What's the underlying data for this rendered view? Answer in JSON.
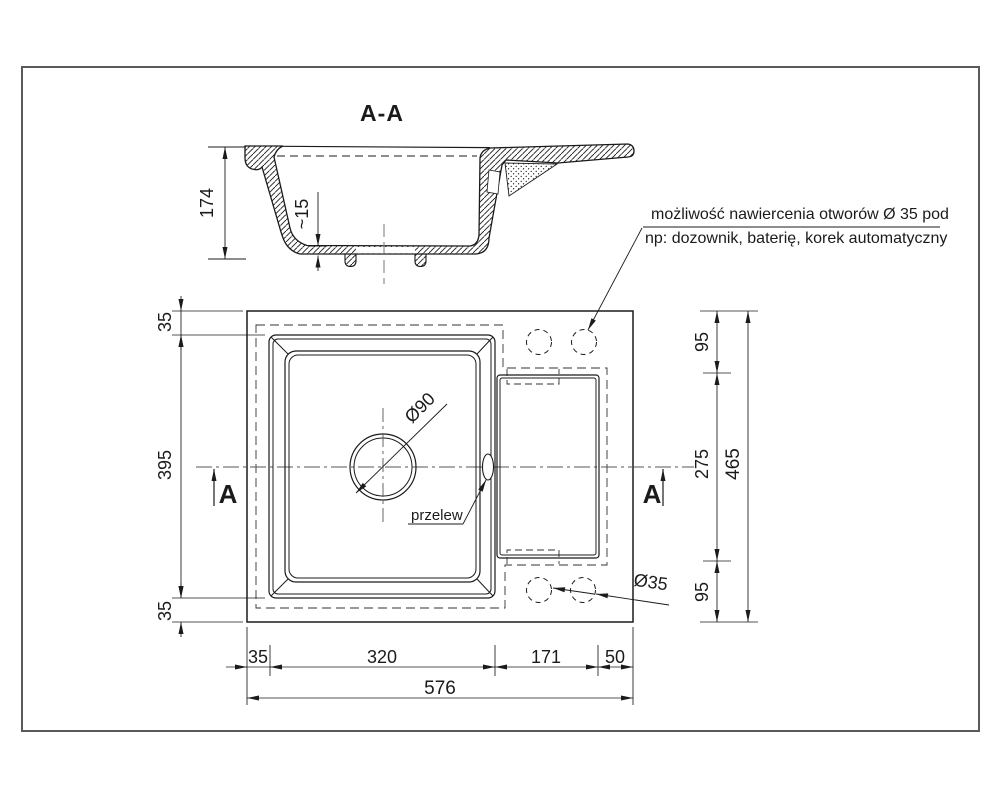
{
  "drawing": {
    "section": {
      "title": "A-A",
      "dim_height": "174",
      "dim_bottom_thickness": "~15"
    },
    "note": {
      "line1": "możliwość nawiercenia otworów Ø 35 pod",
      "line2": "np:  dozownik, baterię, korek automatyczny"
    },
    "plan": {
      "drain_label": "Ø90",
      "overflow_label": "przelew",
      "holes_label": "Ø35",
      "section_marker_left": "A",
      "section_marker_right": "A",
      "dims": {
        "left_top": "35",
        "left_mid": "395",
        "left_bottom": "35",
        "right_top": "95",
        "right_mid": "275",
        "right_bottom": "95",
        "right_total": "465",
        "bottom_1": "35",
        "bottom_2": "320",
        "bottom_3": "171",
        "bottom_4": "50",
        "bottom_total": "576"
      }
    },
    "colors": {
      "line": "#1b1b1b",
      "frame": "#5a5a5a",
      "centerline": "#555555",
      "background": "#ffffff"
    }
  }
}
